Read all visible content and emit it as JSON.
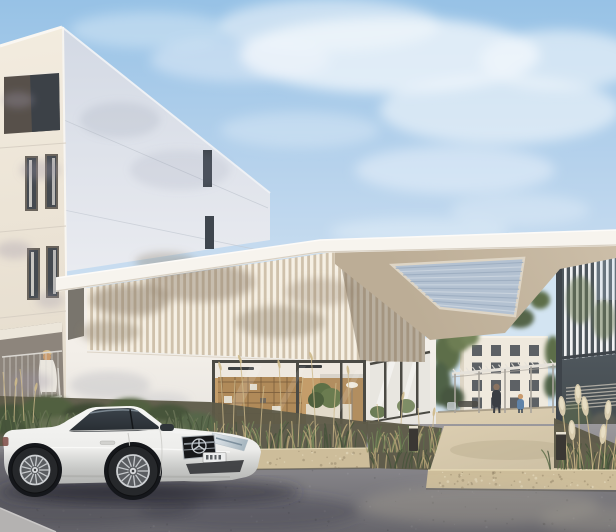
{
  "meta": {
    "width": 616,
    "height": 532,
    "alt": "Daytime architectural rendering of a modern white residential complex: a four-storey apartment block at left, a flat entrance canopy with vertical louver band and ribbed skylight, a glazed lobby, a gravel walkway leading to a courtyard building with a pergola and two pedestrians, ornamental grasses, two bollard lights, and a white Mercedes coupe parked on the asphalt in front."
  },
  "scene": {
    "sky": {
      "top": "#97c2e6",
      "mid": "#b6d2ec",
      "horizon": "#d3e3f2",
      "cloud": "#f4f8fc"
    },
    "left_building": {
      "facade_sunlit": "#f3ecdf",
      "facade_shadow": "#e3dacb",
      "side_face_top": "#d3d9e4",
      "side_face_bottom": "#e9ebf0",
      "window_glass": "#41474f",
      "window_frame": "#6a645c",
      "curtain": "#eae6df",
      "recess_dark": "#57504a",
      "terrace_shadow": "#8d857c",
      "railing": "#dad7d1"
    },
    "pavilion": {
      "slat_light": "#f6f0e4",
      "slat_gap": "#cfc1ab",
      "shade_overlay": "#6f5f4c",
      "wall_white": "#f3efe9",
      "frame_dark": "#4b4a44",
      "interior_wall": "#c49d6a",
      "interior_wood": "#7c5f3d",
      "interior_ceiling": "#eee8df",
      "counter": "#e2dac9",
      "plant_green": "#5d7046"
    },
    "canopy": {
      "fascia": "#f7f4ee",
      "fascia_edge": "#d8d0c3",
      "soffit": "#ccbea8",
      "soffit_deep": "#bcad96",
      "skylight_base": "#b3c1d1",
      "skylight_rib": "#9cadc0",
      "skylight_rib_light": "#ccd6e0",
      "skylight_frame": "#ded5c5"
    },
    "right_wing": {
      "slat": "#f0f1f2",
      "glass_dark": "#4e565c",
      "glass_deep": "#434a4c",
      "reflect_green": "#68774f",
      "reflect_sky": "#b7cfe2",
      "frame": "#3e444a",
      "louver": "#c7c1b5"
    },
    "background_building": {
      "wall": "#efe9dd",
      "side": "#ded6c6",
      "window": "#4d5258",
      "floors": 4,
      "window_columns": 4
    },
    "pergola": {
      "beam_light": "#e6e2da",
      "beam_shade": "#a8a39b"
    },
    "people": {
      "count_courtyard": 2,
      "count_terrace": 1,
      "adult": "#3a3e44",
      "child_blue": "#5f83a8",
      "skin": "#c99b6e",
      "terrace_top": "#eae6de",
      "hair": "#d9bd8a"
    },
    "ground": {
      "asphalt_light": "#9b999c",
      "asphalt_dark": "#67666c",
      "shadow": "#3f3f49",
      "path": "#cfc2a6",
      "path_sunlit": "#dbcdb0",
      "curb_stone": "#cdbd9a",
      "soil": "#5d5a48",
      "sidewalk": "#b4b2b1"
    },
    "vegetation": {
      "green_dark": "#46543b",
      "green_mid": "#5d6e49",
      "green_light": "#75855a",
      "grey_green": "#6b7458",
      "grass_dry": "#b3a176",
      "grass_straw": "#cdb98b",
      "pampas": "#ddd1b2",
      "pampas_light": "#e9e0c6"
    },
    "car": {
      "brand_mark": "mercedes-star",
      "license_plate": {
        "visible": true,
        "legible": false
      },
      "body_top": "#f7f7f5",
      "body_mid": "#ededeb",
      "body_low": "#c7c8c6",
      "body_deep": "#b4b5b3",
      "glass": "#272c31",
      "glass_highlight": "#8c98a2",
      "tire": "#26282b",
      "arch": "#15171b",
      "rim": "#c6c9cc",
      "rim_face": "#5a5d61",
      "grille": "#17181a",
      "chrome": "#c9ced3",
      "headlight_hi": "#e3e8ec",
      "headlight_lo": "#9fb0ba",
      "plate": "#eceded",
      "shadow": "#30313a"
    },
    "bollard": {
      "body": "#3a3733",
      "cap": "#e8e2d2",
      "count": 2
    }
  }
}
